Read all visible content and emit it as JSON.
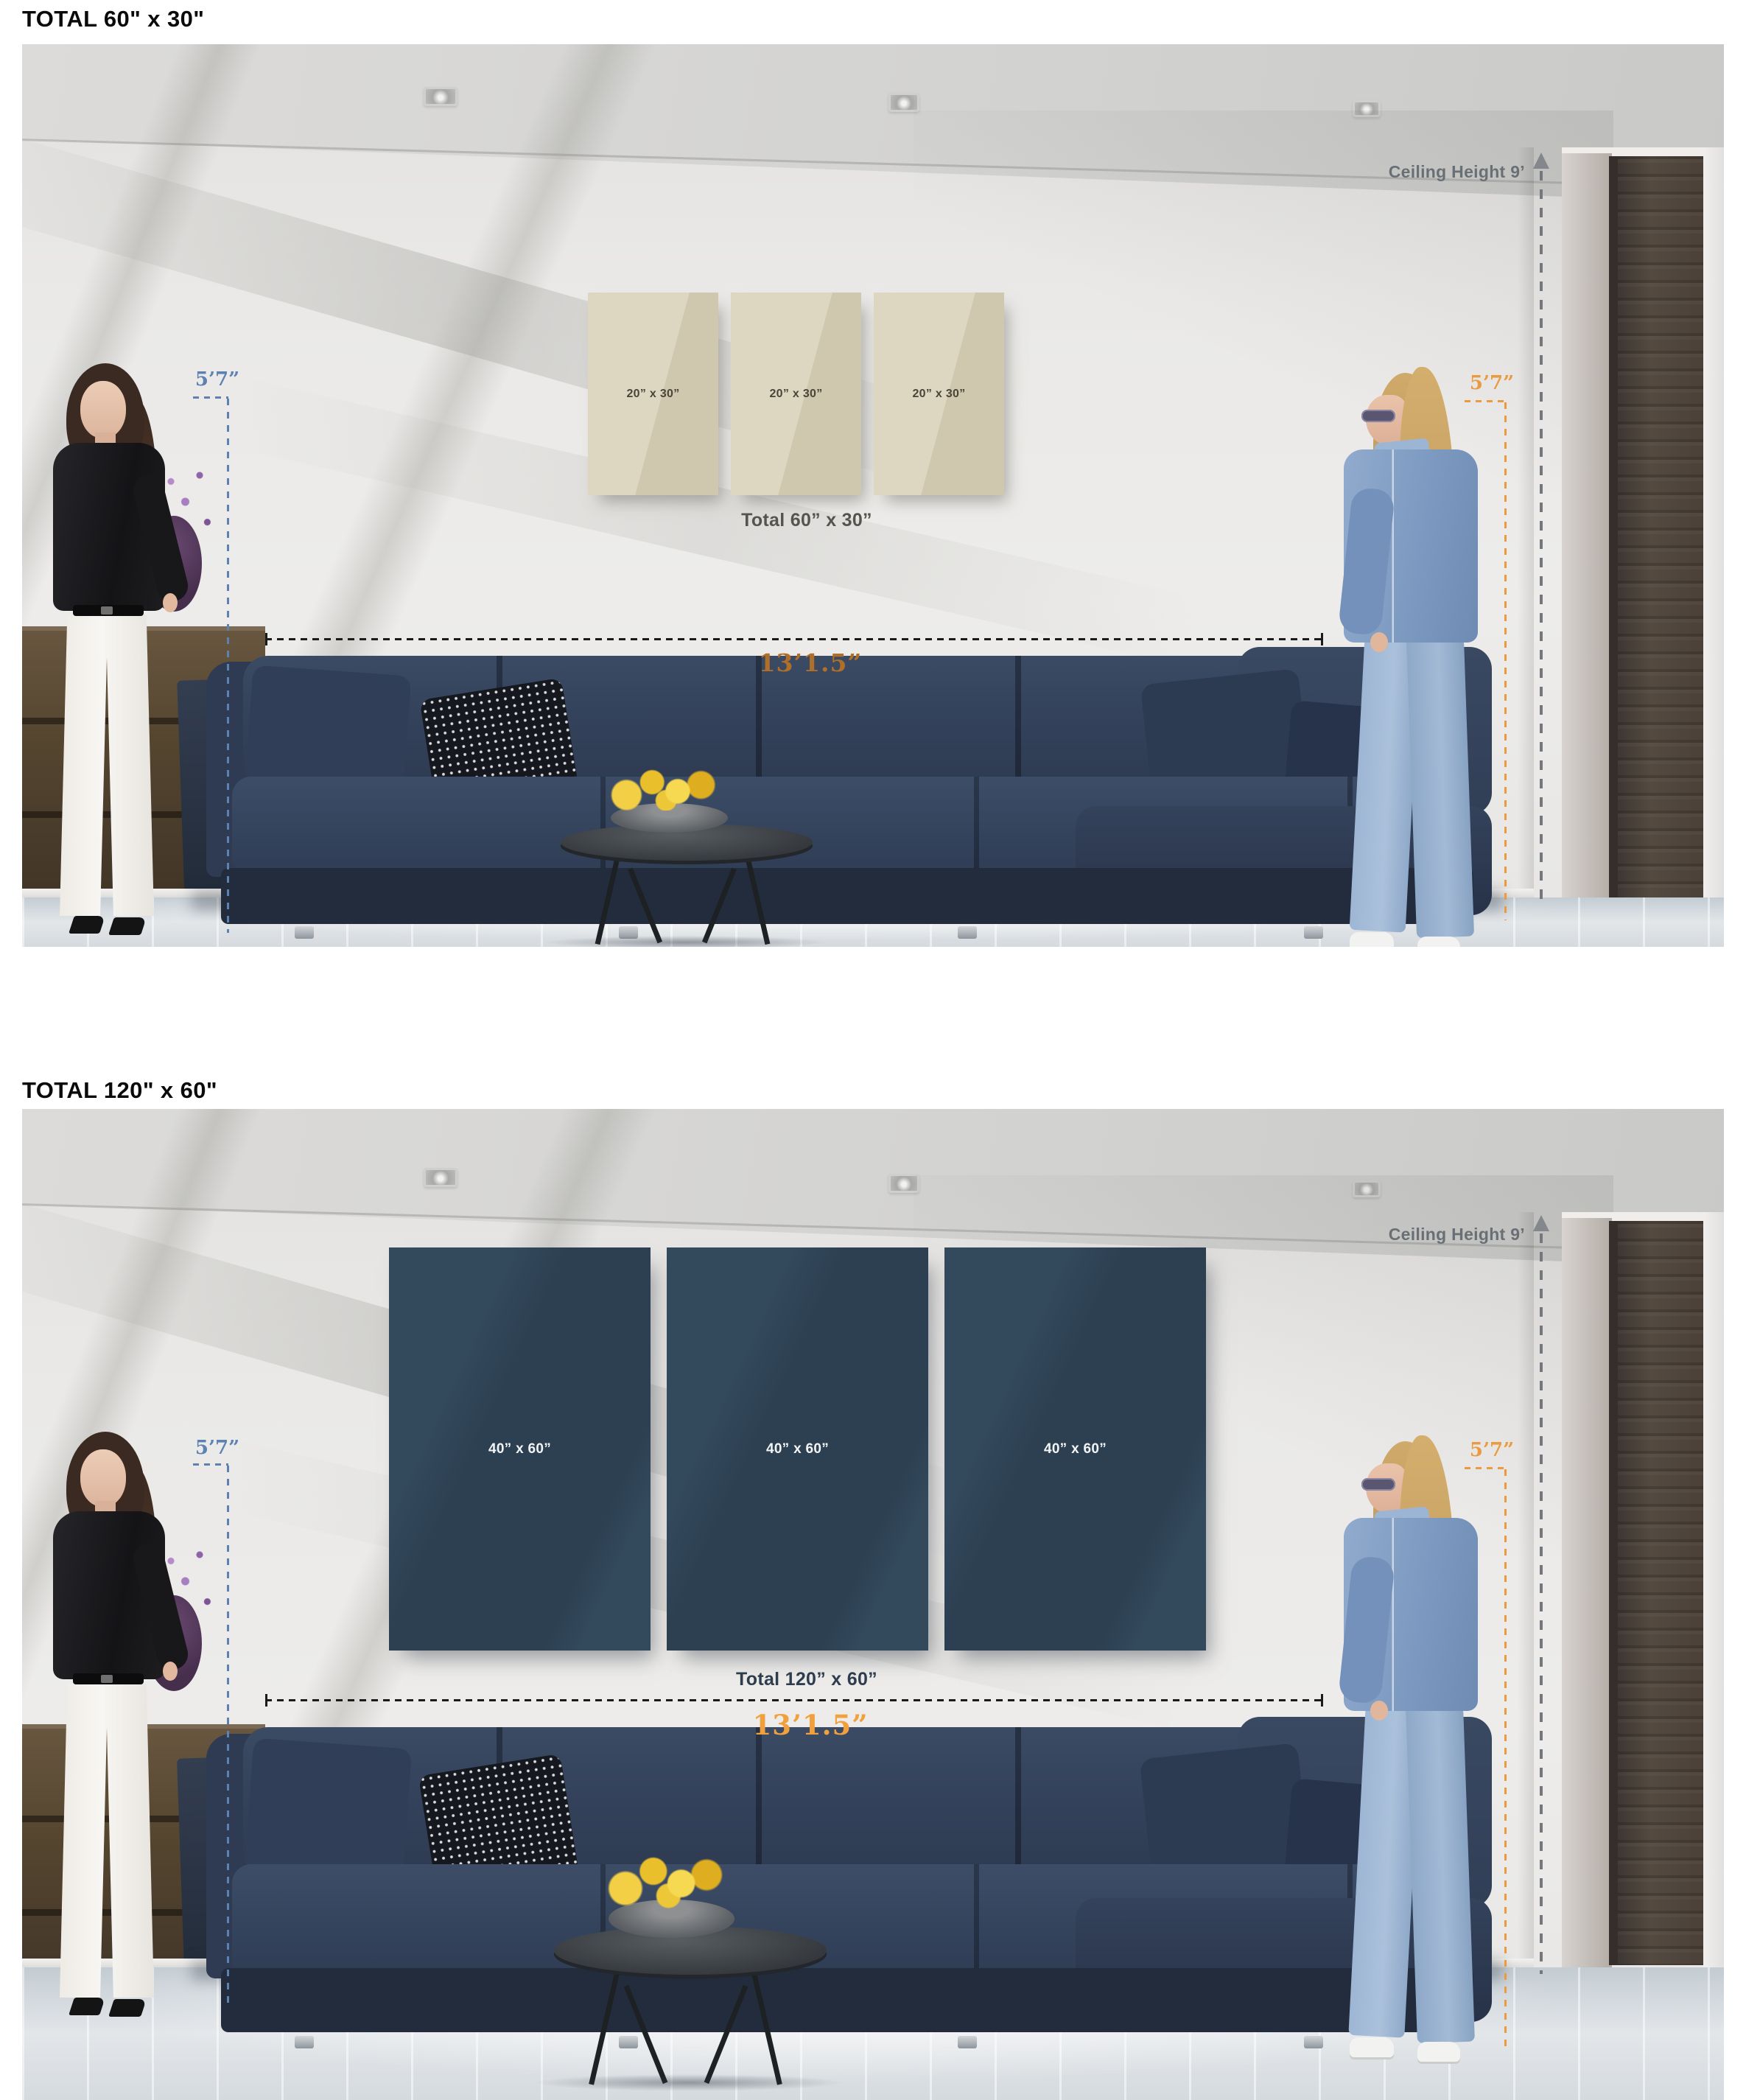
{
  "colors": {
    "annotation_blue": "#5d82b2",
    "annotation_orange": "#eb9b3f",
    "dimension_copper_top": "#b06f28",
    "dimension_orange_bottom": "#f0a13e",
    "ceiling_annotation_gray": "#697075",
    "canvas_beige": "#d8d0b9",
    "canvas_navy": "#33495c"
  },
  "panels": [
    {
      "title": "TOTAL 60\" x 30\"",
      "ceiling_label": "Ceiling Height 9’",
      "left_person_height": "5’7”",
      "right_person_height": "5’7”",
      "sofa_width": "13’1.5”",
      "canvases": [
        "20” x 30”",
        "20” x 30”",
        "20” x 30”"
      ],
      "total_label": "Total 60” x 30”"
    },
    {
      "title": "TOTAL 120\" x 60\"",
      "ceiling_label": "Ceiling Height 9’",
      "left_person_height": "5’7”",
      "right_person_height": "5’7”",
      "sofa_width": "13’1.5”",
      "canvases": [
        "40” x 60”",
        "40” x 60”",
        "40” x 60”"
      ],
      "total_label": "Total 120” x 60”"
    }
  ]
}
